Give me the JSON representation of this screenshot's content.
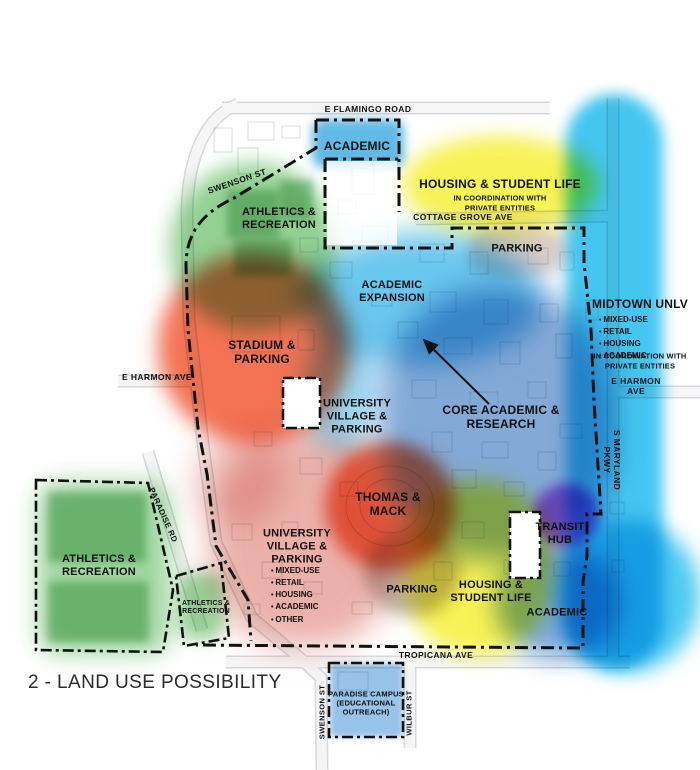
{
  "title": "2 - LAND USE POSSIBILITY",
  "roads": {
    "flamingo": "E FLAMINGO ROAD",
    "swenson_north": "SWENSON ST",
    "cottage_grove": "COTTAGE GROVE AVE",
    "harmon_west": "E HARMON AVE",
    "harmon_east": "E HARMON AVE",
    "maryland": "S MARYLAND PKWY",
    "paradise": "PARADISE RD",
    "tropicana": "TROPICANA AVE",
    "swenson_south": "SWENSON ST",
    "wilbur": "WILBUR ST"
  },
  "zones": {
    "academic_north": {
      "label": "ACADEMIC",
      "color": "#45aee2"
    },
    "housing_north": {
      "label": "HOUSING & STUDENT LIFE",
      "note": "IN COORDINATION WITH\nPRIVATE ENTITIES",
      "color": "#f6f143"
    },
    "athletics_north": {
      "label": "ATHLETICS &\nRECREATION",
      "color": "#6fc26f"
    },
    "parking_north": {
      "label": "PARKING",
      "color": "#d8c9c6"
    },
    "academic_expansion": {
      "label": "ACADEMIC\nEXPANSION",
      "color": "#45b9ea"
    },
    "core_academic": {
      "label": "CORE ACADEMIC &\nRESEARCH",
      "color": "#6493cc"
    },
    "midtown": {
      "label": "MIDTOWN UNLV",
      "items": [
        "MIXED-USE",
        "RETAIL",
        "HOUSING",
        "ACADEMIC"
      ],
      "note": "IN COORDINATION WITH\nPRIVATE ENTITIES",
      "color": "#2fc0ef"
    },
    "stadium": {
      "label": "STADIUM &\nPARKING",
      "color": "#f15a35"
    },
    "university_village_mid": {
      "label": "UNIVERSITY\nVILLAGE &\nPARKING"
    },
    "thomas_mack": {
      "label": "THOMAS &\nMACK",
      "color": "#f15a35"
    },
    "university_village_south": {
      "label": "UNIVERSITY\nVILLAGE &\nPARKING",
      "items": [
        "MIXED-USE",
        "RETAIL",
        "HOUSING",
        "ACADEMIC",
        "OTHER"
      ],
      "color": "#df7f74"
    },
    "athletics_southwest": {
      "label": "ATHLETICS &\nRECREATION",
      "color": "#74c474"
    },
    "athletics_southwest_small": {
      "label": "ATHLETICS &\nRECREATION"
    },
    "parking_south": {
      "label": "PARKING",
      "color": "#a89c90"
    },
    "housing_south": {
      "label": "HOUSING &\nSTUDENT LIFE",
      "color": "#f6f143"
    },
    "transit_hub": {
      "label": "TRANSIT\nHUB",
      "color": "#c14fd8"
    },
    "academic_south": {
      "label": "ACADEMIC",
      "color": "#5590d2"
    },
    "paradise_campus": {
      "label": "PARADISE CAMPUS\n(EDUCATIONAL\nOUTREACH)",
      "color": "#7db4e4"
    }
  }
}
